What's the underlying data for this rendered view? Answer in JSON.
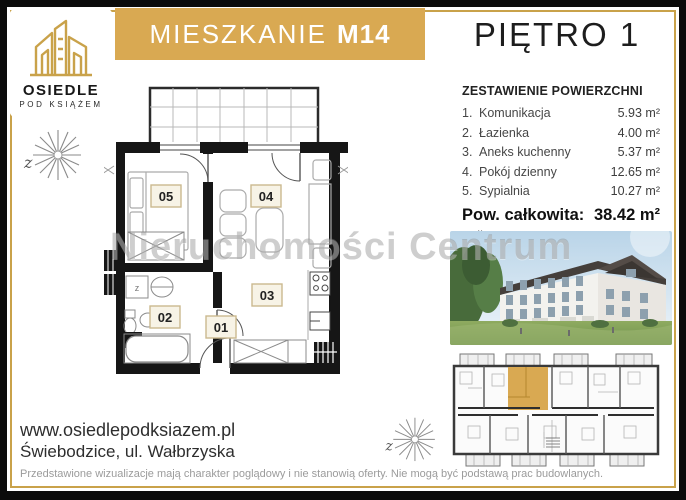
{
  "colors": {
    "gold": "#D9A952",
    "gold_border": "#C9A24A",
    "frame_black": "#0b0b0b",
    "highlight_unit": "#D9A952"
  },
  "logo": {
    "icon": "buildings-outline-icon",
    "line1": "OSIEDLE",
    "line2": "POD KSIĄŻEM"
  },
  "header": {
    "title_label": "MIESZKANIE",
    "unit_code": "M14",
    "floor_label": "PIĘTRO 1"
  },
  "summary": {
    "heading": "ZESTAWIENIE POWIERZCHNI",
    "rows": [
      {
        "no": "1.",
        "name": "Komunikacja",
        "area": "5.93 m²"
      },
      {
        "no": "2.",
        "name": "Łazienka",
        "area": "4.00 m²"
      },
      {
        "no": "3.",
        "name": "Aneks kuchenny",
        "area": "5.37 m²"
      },
      {
        "no": "4.",
        "name": "Pokój dzienny",
        "area": "12.65 m²"
      },
      {
        "no": "5.",
        "name": "Sypialnia",
        "area": "10.27 m²"
      }
    ],
    "total_label": "Pow. całkowita:",
    "total_area": "38.42 m²",
    "balcony_label": "Balkon",
    "balcony_area": "6.98 m²"
  },
  "floorplan": {
    "room_labels": {
      "r01": "01",
      "r02": "02",
      "r03": "03",
      "r04": "04",
      "r05": "05"
    },
    "washer_label": "z"
  },
  "compass": {
    "mark": "z"
  },
  "watermark_text": "Nieruchomości Centrum",
  "footer": {
    "website": "www.osiedlepodksiazem.pl",
    "address": "Świebodzice, ul. Wałbrzyska",
    "disclaimer": "Przedstawione wizualizacje mają charakter poglądowy i nie stanowią oferty. Nie mogą być podstawą prac budowlanych."
  }
}
